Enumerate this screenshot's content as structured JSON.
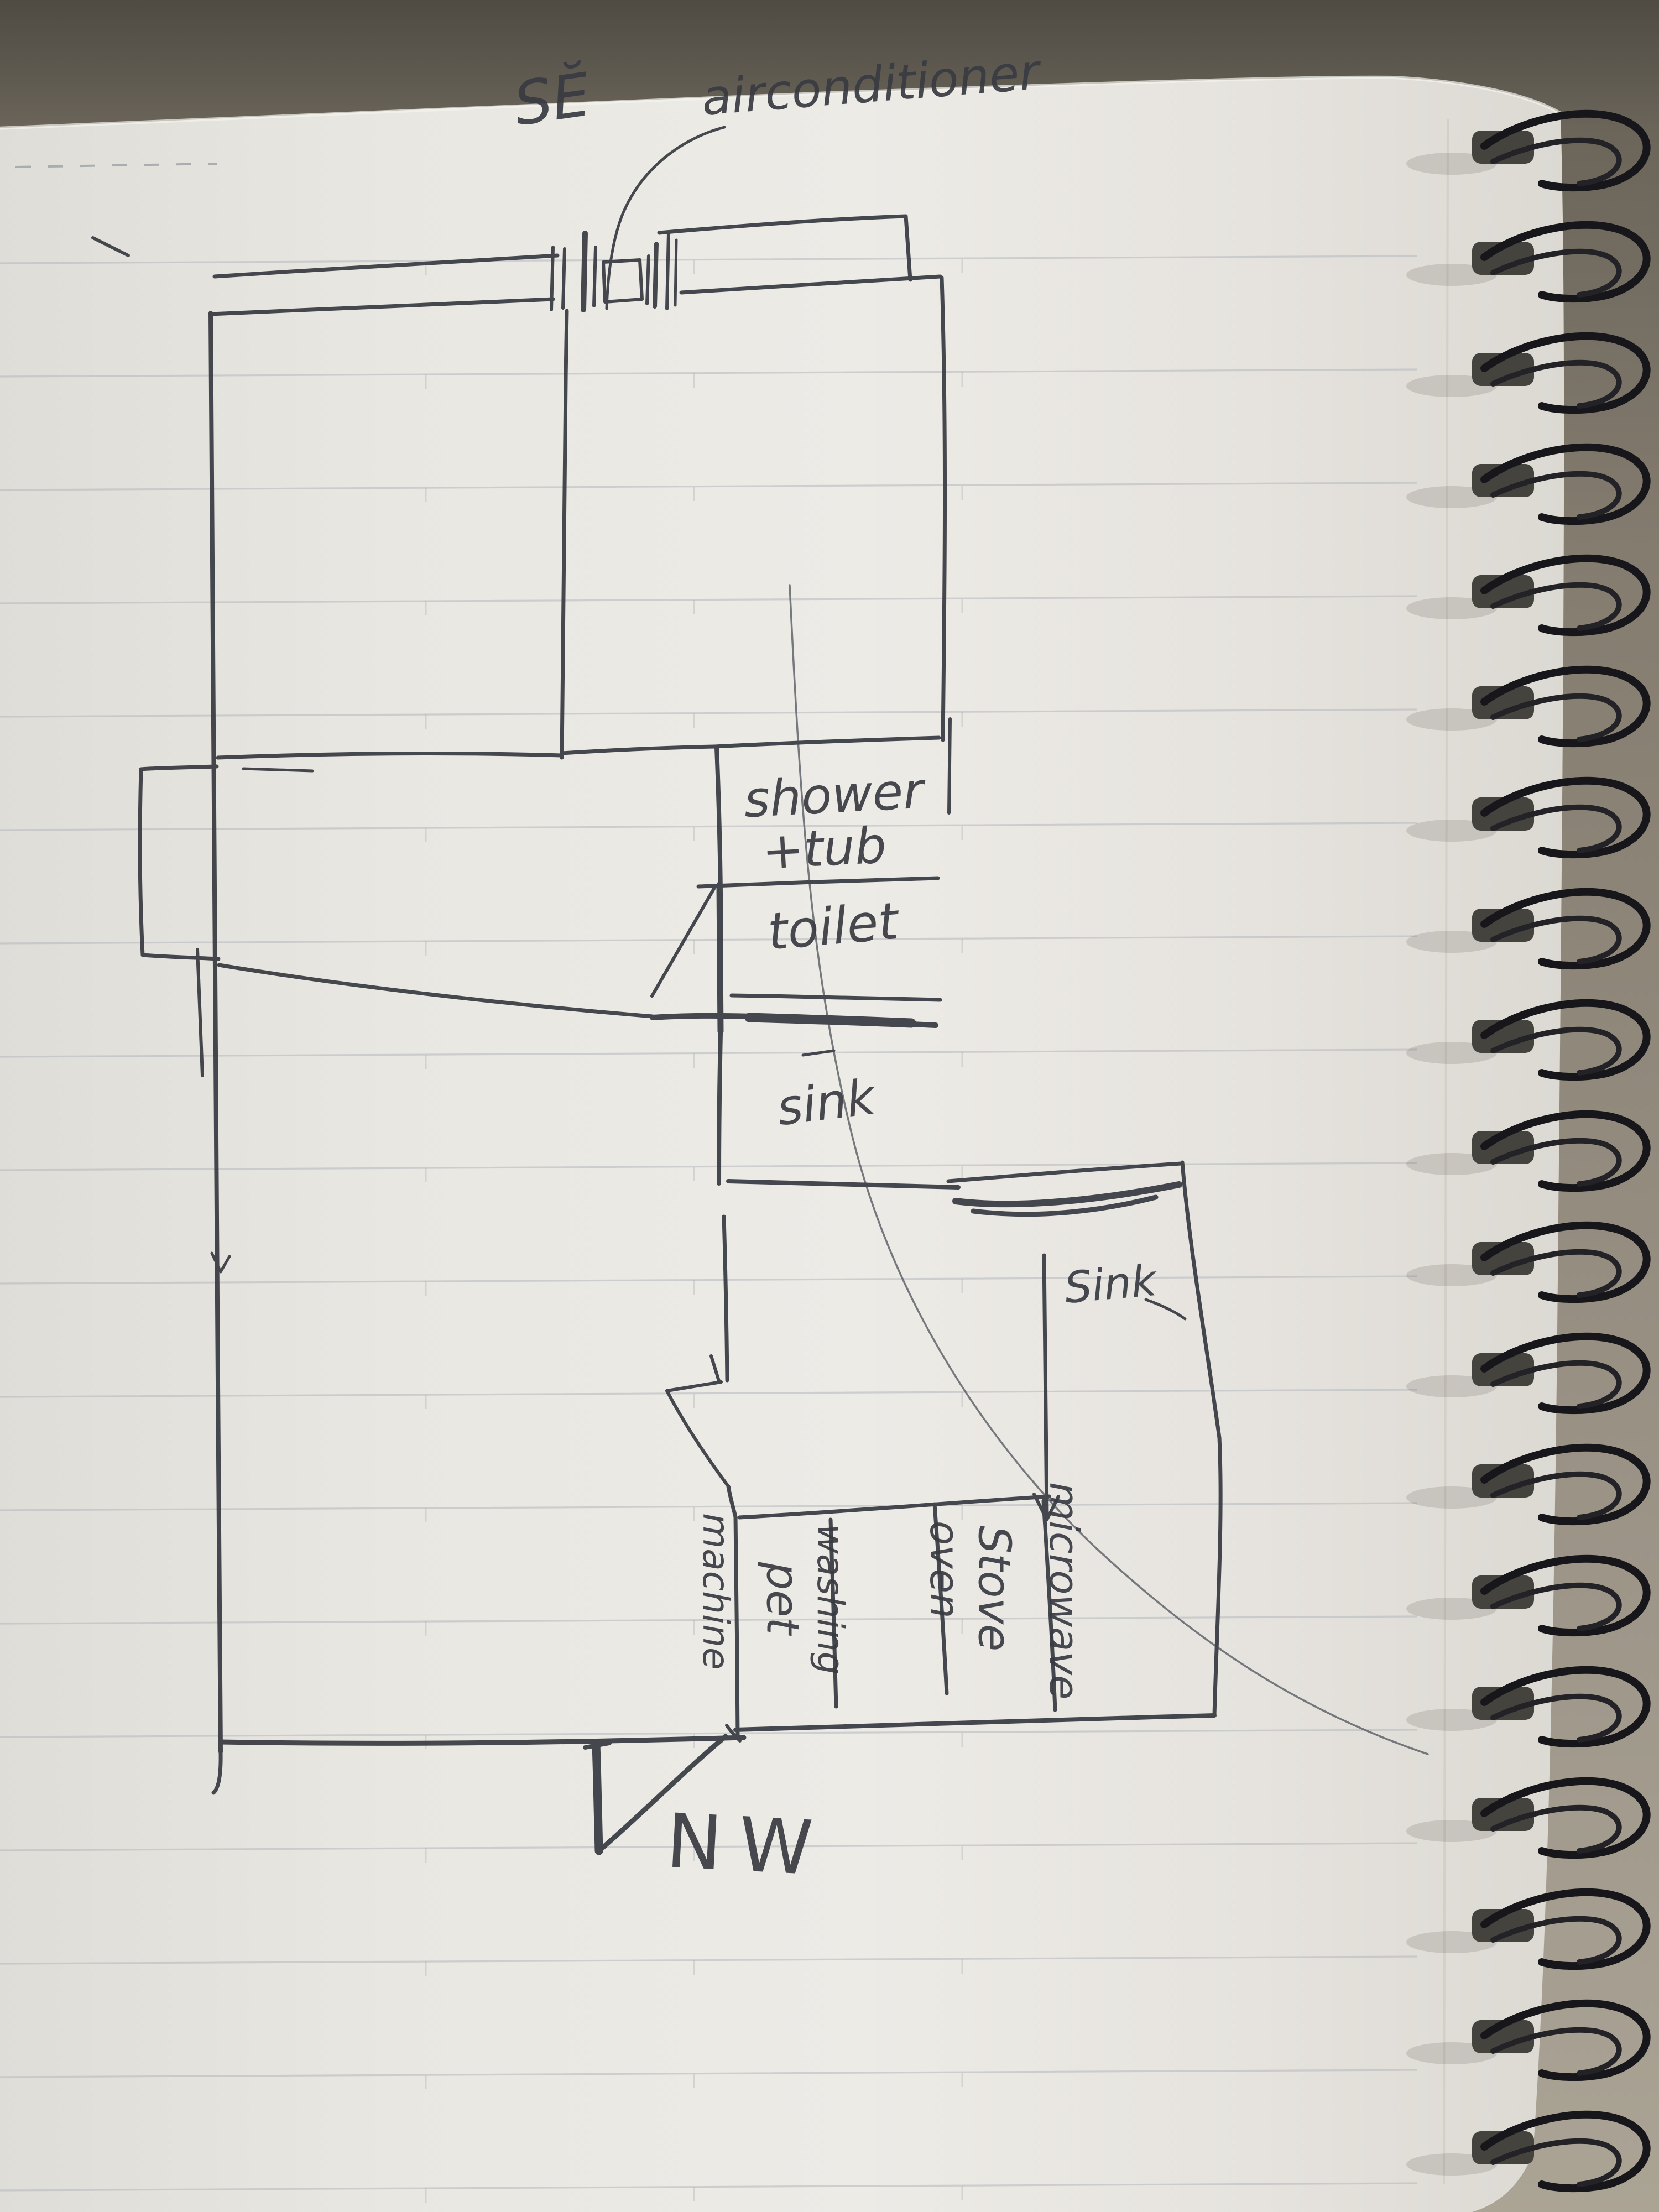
{
  "labels": {
    "se_direction": "SĔ",
    "airconditioner": "airconditioner",
    "shower_line1": "shower",
    "shower_line2": "+tub",
    "toilet": "toilet",
    "bathroom_sink": "sink",
    "kitchen_sink": "Sink",
    "microwave_line1": "microwave",
    "microwave_line2": "oven",
    "stove": "Stove",
    "washing_line1": "washing",
    "washing_line2": "machine",
    "pet": "pet",
    "nw_direction": "NW"
  },
  "colors": {
    "ink": "#383b42",
    "paper": "#e8e6e1",
    "desk": "#8b8376",
    "ruled_line": "#b7bbc0",
    "spiral_coil": "#1b1b1f"
  }
}
